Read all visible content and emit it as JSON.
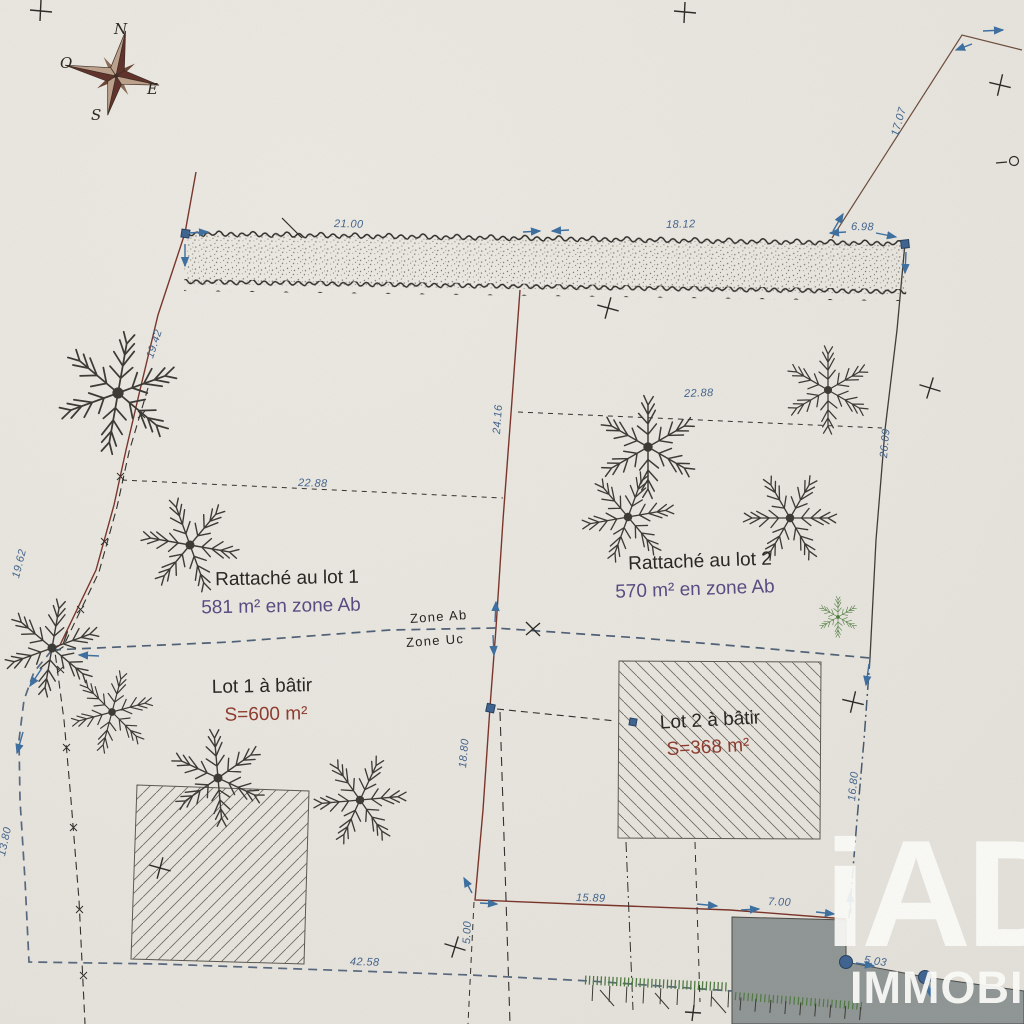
{
  "plan": {
    "compass": {
      "north": "N",
      "west": "O",
      "east": "E",
      "south": "S"
    },
    "parcels": {
      "attached1": {
        "title": "Rattaché au lot 1",
        "area": "581 m² en zone Ab"
      },
      "attached2": {
        "title": "Rattaché au lot 2",
        "area": "570 m² en zone Ab"
      },
      "lot1": {
        "title": "Lot 1 à bâtir",
        "area": "S=600 m²"
      },
      "lot2": {
        "title": "Lot 2 à bâtir",
        "area": "S=368 m²"
      }
    },
    "zones": {
      "above": "Zone Ab",
      "below": "Zone Uc"
    },
    "measurements": [
      {
        "label": "21.00"
      },
      {
        "label": "18.12"
      },
      {
        "label": "6.98"
      },
      {
        "label": "17.07"
      },
      {
        "label": "19.42"
      },
      {
        "label": "24.16"
      },
      {
        "label": "22.88"
      },
      {
        "label": "22.88"
      },
      {
        "label": "26.09"
      },
      {
        "label": "19.62"
      },
      {
        "label": "18.80"
      },
      {
        "label": "16.80"
      },
      {
        "label": "15.89"
      },
      {
        "label": "5.00"
      },
      {
        "label": "42.58"
      },
      {
        "label": "7.00"
      },
      {
        "label": "5.03"
      },
      {
        "label": "13.80"
      }
    ],
    "watermark": {
      "brand": "iAD",
      "subtitle": "IMMOBILIER"
    },
    "colors": {
      "paper": "#e9e6e0",
      "measurement_blue": "#41638c",
      "boundary_red": "#7a3328",
      "zone_purple": "#564a82",
      "lot_red": "#8d3a2c",
      "ink": "#2b2925",
      "gray_area": "#8f9695",
      "tree_green": "#4c7a3c",
      "watermark_white": "#fdfdfa"
    }
  }
}
